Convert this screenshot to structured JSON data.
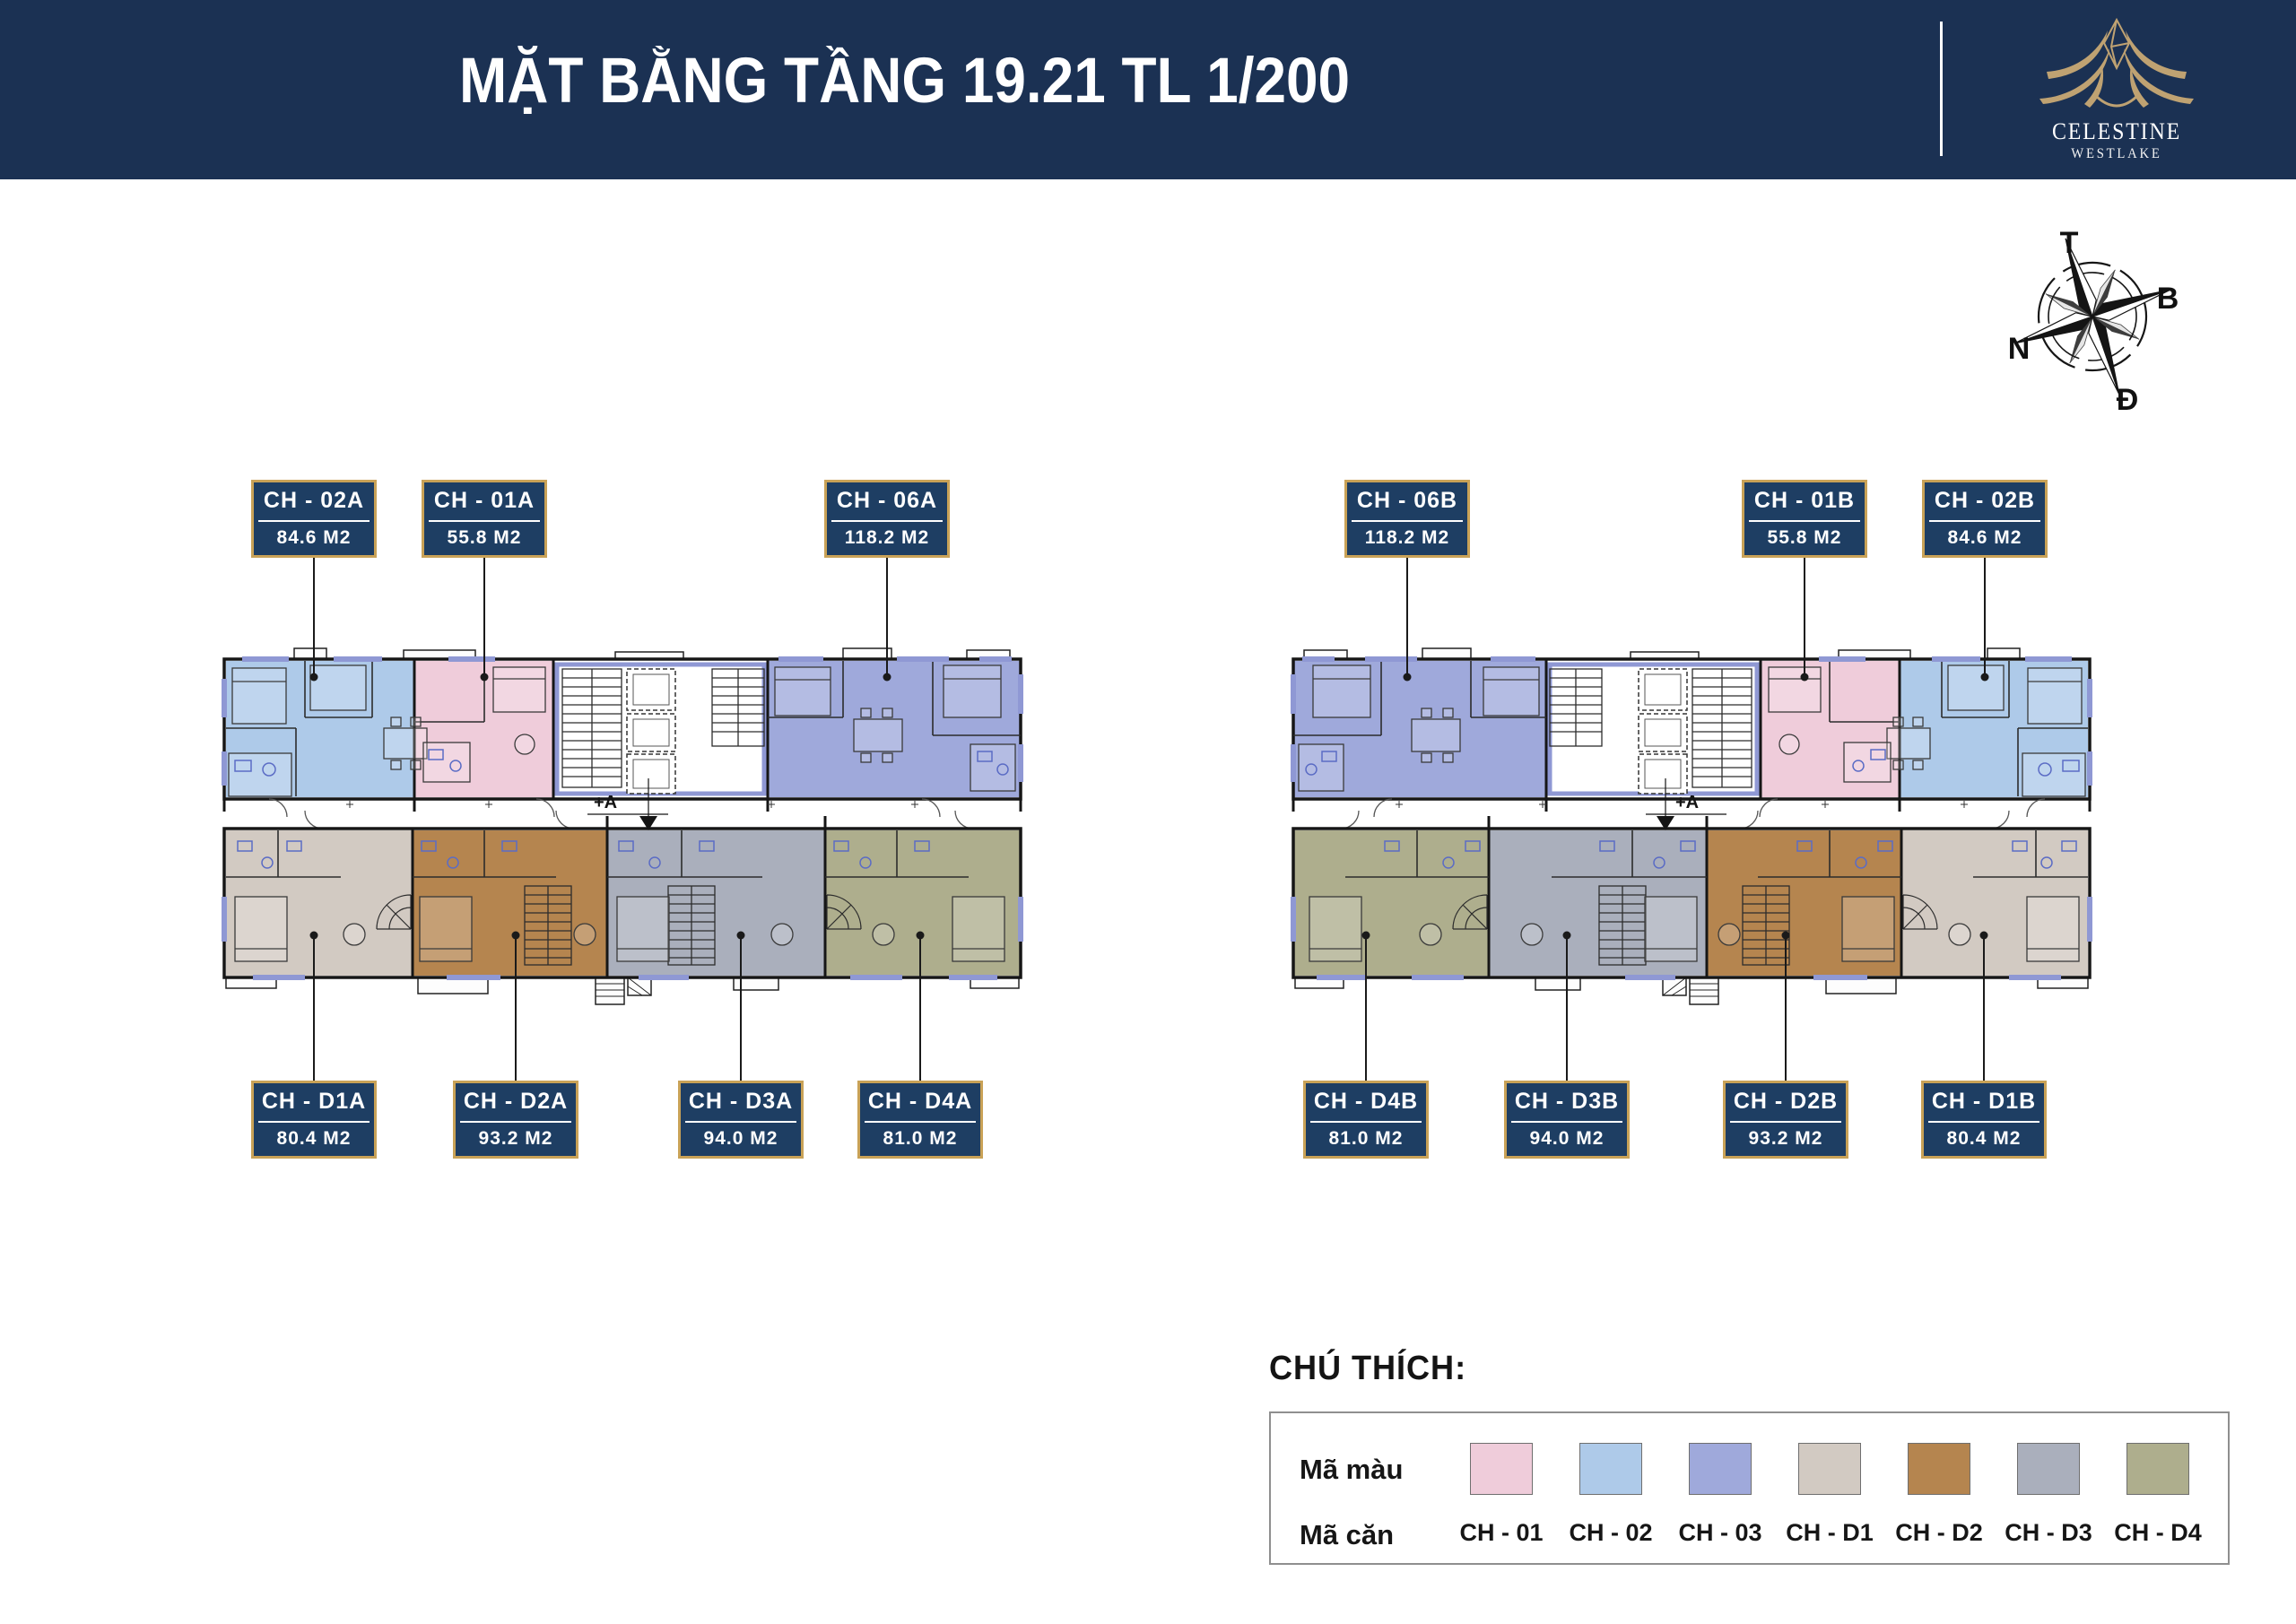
{
  "header": {
    "title": "MẶT BẰNG TẦNG 19.21 TL 1/200",
    "brand_name": "CELESTINE",
    "brand_sub": "WESTLAKE"
  },
  "compass": {
    "top": "T",
    "right": "B",
    "left": "N",
    "bottom": "Đ"
  },
  "annotations": {
    "section_marker": "+A"
  },
  "units": [
    {
      "code": "CH - 02A",
      "area": "84.6 M2"
    },
    {
      "code": "CH - 01A",
      "area": "55.8 M2"
    },
    {
      "code": "CH - 06A",
      "area": "118.2 M2"
    },
    {
      "code": "CH - 06B",
      "area": "118.2 M2"
    },
    {
      "code": "CH - 01B",
      "area": "55.8 M2"
    },
    {
      "code": "CH - 02B",
      "area": "84.6 M2"
    },
    {
      "code": "CH - D1A",
      "area": "80.4 M2"
    },
    {
      "code": "CH - D2A",
      "area": "93.2 M2"
    },
    {
      "code": "CH - D3A",
      "area": "94.0 M2"
    },
    {
      "code": "CH - D4A",
      "area": "81.0 M2"
    },
    {
      "code": "CH - D4B",
      "area": "81.0 M2"
    },
    {
      "code": "CH - D3B",
      "area": "94.0 M2"
    },
    {
      "code": "CH - D2B",
      "area": "93.2 M2"
    },
    {
      "code": "CH - D1B",
      "area": "80.4 M2"
    }
  ],
  "legend": {
    "title": "CHÚ THÍCH:",
    "color_row_label": "Mã màu",
    "code_row_label": "Mã căn",
    "items": [
      {
        "code": "CH - 01",
        "color": "#efccda"
      },
      {
        "code": "CH - 02",
        "color": "#aecae9"
      },
      {
        "code": "CH - 03",
        "color": "#9fa9db"
      },
      {
        "code": "CH - D1",
        "color": "#d2cac2"
      },
      {
        "code": "CH - D2",
        "color": "#b5854f"
      },
      {
        "code": "CH - D3",
        "color": "#aaafbc"
      },
      {
        "code": "CH - D4",
        "color": "#aeae8d"
      }
    ]
  }
}
